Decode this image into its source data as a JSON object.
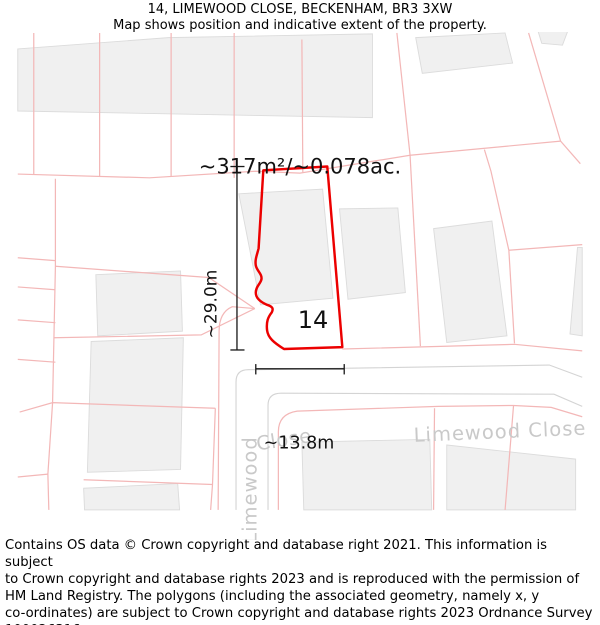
{
  "header": {
    "title": "14, LIMEWOOD CLOSE, BECKENHAM, BR3 3XW",
    "subtitle": "Map shows position and indicative extent of the property."
  },
  "map": {
    "area_label": "~317m²/~0.078ac.",
    "plot_number": "14",
    "dim_vertical": "~29.0m",
    "dim_horizontal": "~13.8m",
    "street_label_right": "Limewood Close",
    "street_label_left_vertical": "Limewood",
    "street_label_bend": "Close",
    "colors": {
      "plot_outline": "#ec0000",
      "parcel_line": "#f3b7b7",
      "building_fill": "#f0f0f0",
      "building_stroke": "#dcdcdc",
      "road_casing": "#d4d4d4",
      "street_text": "#c9c9c9",
      "dimension_line": "#1a1a1a"
    }
  },
  "footer": {
    "lines": [
      "Contains OS data © Crown copyright and database right 2021. This information is subject",
      "to Crown copyright and database rights 2023 and is reproduced with the permission of",
      "HM Land Registry. The polygons (including the associated geometry, namely x, y",
      "co-ordinates) are subject to Crown copyright and database rights 2023 Ordnance Survey",
      "100026316."
    ]
  }
}
